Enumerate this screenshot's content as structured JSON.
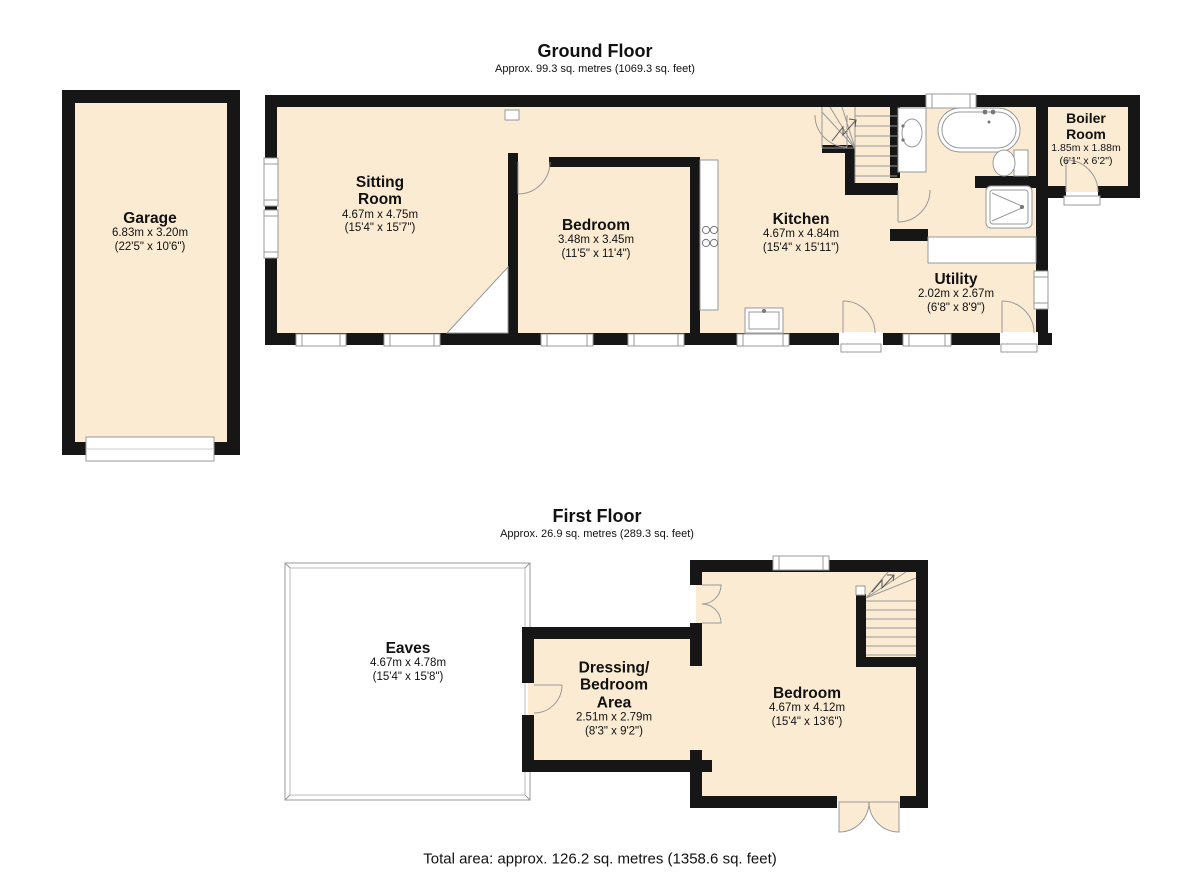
{
  "ground": {
    "title": "Ground Floor",
    "subtitle": "Approx. 99.3 sq. metres (1069.3 sq. feet)",
    "rooms": {
      "garage": {
        "name": "Garage",
        "metric": "6.83m x 3.20m",
        "imperial": "(22'5\" x 10'6\")"
      },
      "sitting": {
        "name": "Sitting\nRoom",
        "metric": "4.67m x 4.75m",
        "imperial": "(15'4\" x 15'7\")"
      },
      "bedroom": {
        "name": "Bedroom",
        "metric": "3.48m x 3.45m",
        "imperial": "(11'5\" x 11'4\")"
      },
      "kitchen": {
        "name": "Kitchen",
        "metric": "4.67m x 4.84m",
        "imperial": "(15'4\" x 15'11\")"
      },
      "utility": {
        "name": "Utility",
        "metric": "2.02m x 2.67m",
        "imperial": "(6'8\" x 8'9\")"
      },
      "boiler": {
        "name": "Boiler\nRoom",
        "metric": "1.85m x 1.88m",
        "imperial": "(6'1\" x 6'2\")"
      }
    }
  },
  "first": {
    "title": "First Floor",
    "subtitle": "Approx. 26.9 sq. metres (289.3 sq. feet)",
    "rooms": {
      "eaves": {
        "name": "Eaves",
        "metric": "4.67m x 4.78m",
        "imperial": "(15'4\" x 15'8\")"
      },
      "dressing": {
        "name": "Dressing/\nBedroom\nArea",
        "metric": "2.51m x 2.79m",
        "imperial": "(8'3\" x 9'2\")"
      },
      "bedroom": {
        "name": "Bedroom",
        "metric": "4.67m x 4.12m",
        "imperial": "(15'4\" x 13'6\")"
      }
    }
  },
  "footer": {
    "total": "Total area: approx. 126.2 sq. metres (1358.6 sq. feet)"
  },
  "colors": {
    "room_fill": "#FAEBD2",
    "wall": "#161616",
    "fixture_stroke": "#999999"
  }
}
